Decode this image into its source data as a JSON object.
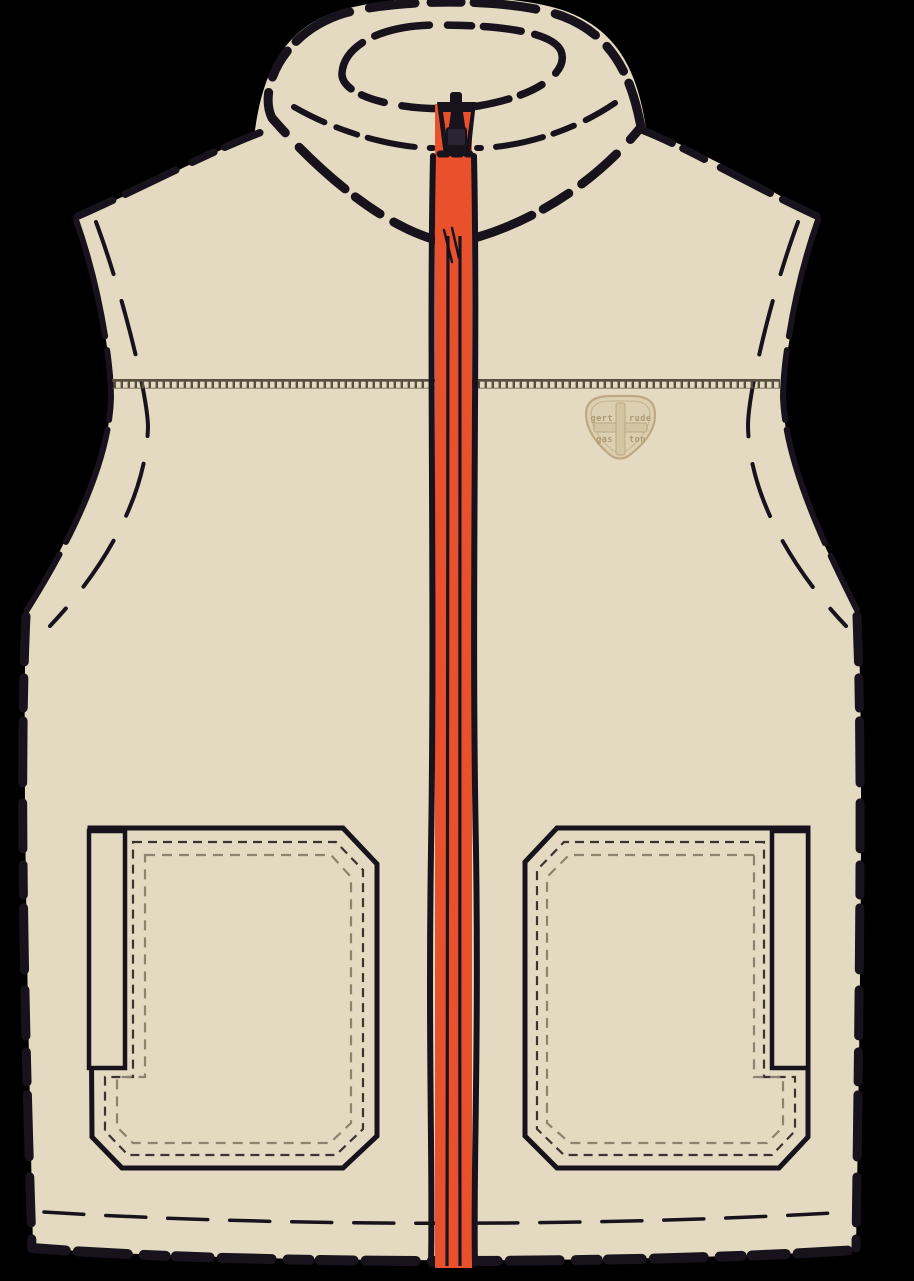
{
  "illustration": {
    "alt": "Technical flat sketch of a beige sherpa fleece zip-up vest with stand collar, orange front zipper, chest brand patch and two large patch pockets on black background",
    "patch": {
      "line1_left": "gert",
      "line1_right": "rude",
      "line2_left": "gas",
      "line2_right": "ton"
    }
  },
  "colors": {
    "background": "#000000",
    "beige": "#E3DAC1",
    "ink": "#18121D",
    "orange": "#E8512C",
    "zip_line": "#1A141F",
    "rail": "#57503E",
    "dash_dark": "#3B352F",
    "dash_gray": "#8B8471",
    "patch_fill": "#DBD1B2",
    "patch_line": "#BFA881",
    "patch_emboss": "#D2C6A3",
    "patch_text": "#AE9A74",
    "pull": "#2B2433"
  }
}
